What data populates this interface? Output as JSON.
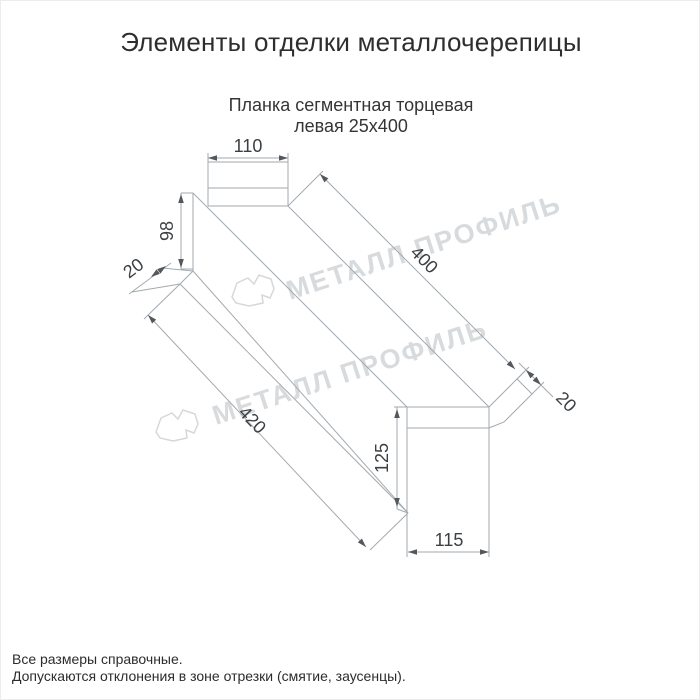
{
  "page": {
    "title": "Элементы отделки металлочерепицы"
  },
  "product": {
    "subtitle_line1": "Планка сегментная торцевая",
    "subtitle_line2": "левая 25х400",
    "size": "25х400"
  },
  "dimensions": {
    "top_width": "110",
    "left_height": "98",
    "left_flange": "20",
    "length_top": "400",
    "right_flange": "20",
    "length_bottom": "420",
    "right_height": "125",
    "bottom_width": "115"
  },
  "watermark": {
    "text": "МЕТАЛЛ ПРОФИЛЬ"
  },
  "footer": {
    "line1": "Все размеры справочные.",
    "line2": "Допускаются отклонения в зоне отрезки (смятие, заусенцы)."
  },
  "colors": {
    "background": "#ffffff",
    "drawing_line": "#a3aaaf",
    "dimension_text": "#3d4043",
    "heading_text": "#2e2e2e",
    "watermark": "#d8dbdd"
  }
}
